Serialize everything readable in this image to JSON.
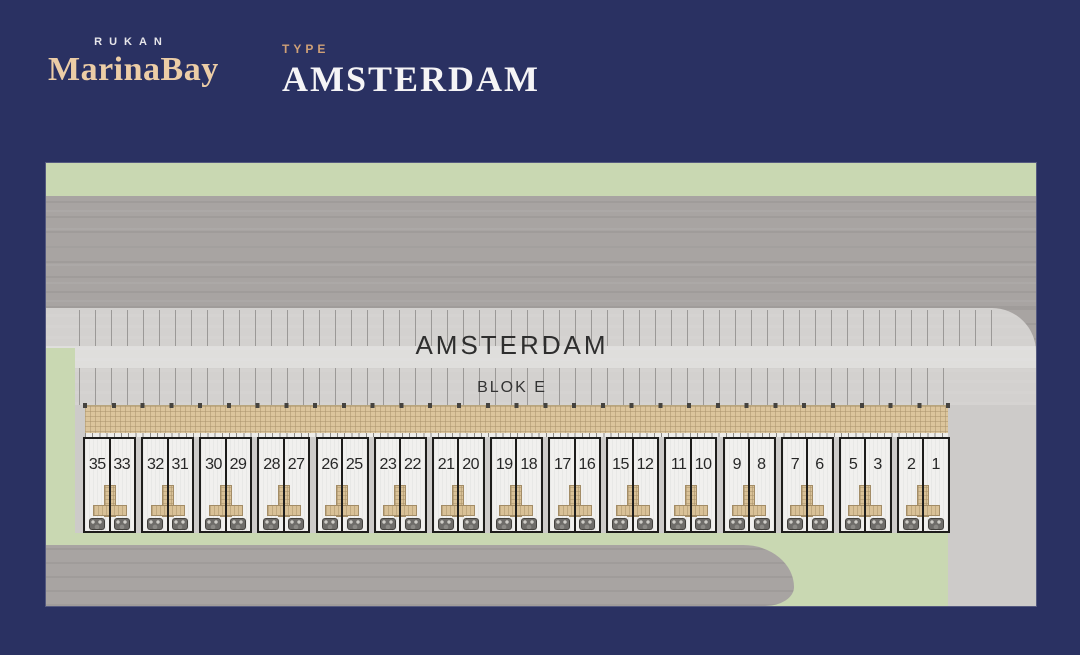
{
  "header": {
    "brand_top": "RUKAN",
    "brand_name": "MarinaBay",
    "type_label": "TYPE",
    "type_value": "AMSTERDAM"
  },
  "siteplan": {
    "area_title": "AMSTERDAM",
    "block_label": "BLOK E",
    "unit_pairs": [
      [
        "35",
        "33"
      ],
      [
        "32",
        "31"
      ],
      [
        "30",
        "29"
      ],
      [
        "28",
        "27"
      ],
      [
        "26",
        "25"
      ],
      [
        "23",
        "22"
      ],
      [
        "21",
        "20"
      ],
      [
        "19",
        "18"
      ],
      [
        "17",
        "16"
      ],
      [
        "15",
        "12"
      ],
      [
        "11",
        "10"
      ],
      [
        "9",
        "8"
      ],
      [
        "7",
        "6"
      ],
      [
        "5",
        "3"
      ],
      [
        "2",
        "1"
      ]
    ],
    "colors": {
      "background_navy": "#2a3162",
      "grass_green": "#c9d8b2",
      "road_gray": "#a8a4a2",
      "pavement_light": "#d3d1cf",
      "canopy_tan": "#dcc59c",
      "unit_white": "#f1f0ee",
      "brand_peach": "#eccda6",
      "type_tan": "#cfa077"
    }
  }
}
